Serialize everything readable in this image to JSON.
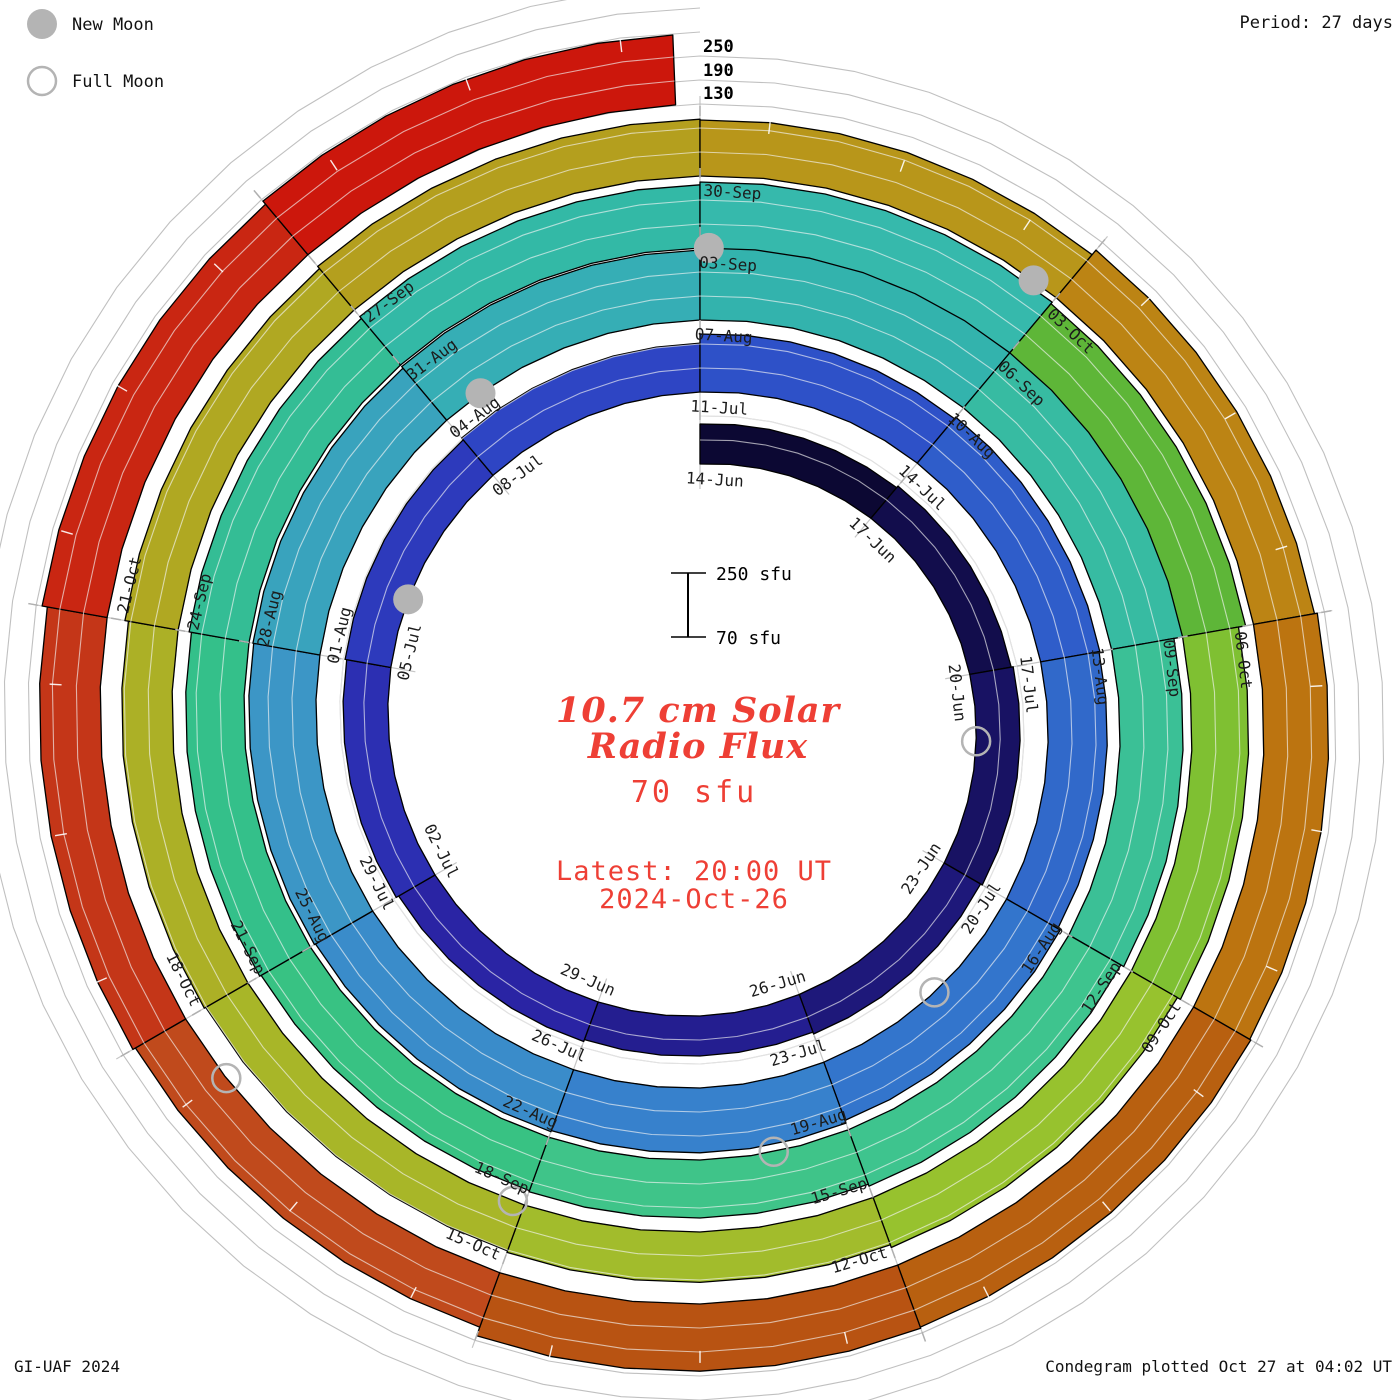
{
  "legend": {
    "new_moon_label": "New Moon",
    "full_moon_label": "Full Moon"
  },
  "period_label": "Period: 27 days",
  "credit": "GI-UAF 2024",
  "footer_note": "Condegram plotted Oct 27 at 04:02 UT",
  "radial_scale_labels": [
    "250",
    "190",
    "130"
  ],
  "center": {
    "scalebar_top": "250 sfu",
    "scalebar_bottom": "70 sfu",
    "title_line1": "10.7 cm Solar",
    "title_line2": "Radio Flux",
    "baseline_label": "70 sfu",
    "latest_line1": "Latest: 20:00 UT",
    "latest_line2": "2024-Oct-26"
  },
  "colors": {
    "text_red": "#ee3f35",
    "moon_gray": "#b4b4b4",
    "grid_gray": "#c0c0c0",
    "radial_gray": "#c6c6c6",
    "tick_gray": "#b0b0b0",
    "label_black": "#1c1c1c"
  },
  "chart_data": {
    "type": "spiral-polar-condegram",
    "title": "10.7 cm Solar Radio Flux",
    "units": "sfu",
    "start_date": "2024-Jun-14",
    "end_date_value": "2024-Oct-26 20:00 UT",
    "period_days": 27,
    "segment_days": 3,
    "baseline_sfu": 70,
    "grid_levels_sfu": [
      130,
      190,
      250
    ],
    "total_days": 134.83,
    "boundary_date_labels": [
      "14-Jun",
      "17-Jun",
      "20-Jun",
      "23-Jun",
      "26-Jun",
      "29-Jun",
      "02-Jul",
      "05-Jul",
      "08-Jul",
      "11-Jul",
      "14-Jul",
      "17-Jul",
      "20-Jul",
      "23-Jul",
      "26-Jul",
      "29-Jul",
      "01-Aug",
      "04-Aug",
      "07-Aug",
      "10-Aug",
      "13-Aug",
      "16-Aug",
      "19-Aug",
      "22-Aug",
      "25-Aug",
      "28-Aug",
      "31-Aug",
      "03-Sep",
      "06-Sep",
      "09-Sep",
      "12-Sep",
      "15-Sep",
      "18-Sep",
      "21-Sep",
      "24-Sep",
      "27-Sep",
      "30-Sep",
      "03-Oct",
      "06-Oct",
      "09-Oct",
      "12-Oct",
      "15-Oct",
      "18-Oct",
      "21-Oct"
    ],
    "segment_flux_sfu": [
      170,
      175,
      180,
      175,
      170,
      175,
      182,
      186,
      192,
      215,
      220,
      218,
      225,
      232,
      235,
      238,
      240,
      245,
      268,
      252,
      228,
      220,
      215,
      212,
      216,
      222,
      228,
      235,
      230,
      212,
      203,
      196,
      192,
      196,
      205,
      212,
      210,
      225,
      232,
      235,
      238,
      215,
      222,
      235,
      245
    ],
    "segment_colors": [
      "#0c0833",
      "#120d4c",
      "#181263",
      "#1e187a",
      "#241e90",
      "#2a24a4",
      "#2c2fb2",
      "#2d3abc",
      "#2e45c4",
      "#2e51c8",
      "#2f5dca",
      "#3169ca",
      "#3375cc",
      "#3781cc",
      "#3a8cca",
      "#3c96c6",
      "#39a3bd",
      "#36aeb5",
      "#33b3ad",
      "#37bba2",
      "#3bc096",
      "#3ec48e",
      "#3fc489",
      "#38c283",
      "#34c08a",
      "#34bd95",
      "#33b9a6",
      "#36b9ac",
      "#5eb638",
      "#7fc032",
      "#97c22e",
      "#a2bc2c",
      "#a8b628",
      "#acb026",
      "#b0a822",
      "#b49f1e",
      "#b8961a",
      "#bc8414",
      "#bc7410",
      "#b86010",
      "#b85312",
      "#c04a1c",
      "#c43618",
      "#c92612",
      "#cc170c"
    ],
    "new_moon_day_offsets": [
      21.96,
      51.47,
      81.08,
      110.78
    ],
    "full_moon_day_offsets": [
      7.05,
      37.43,
      66.77,
      96.1,
      125.48
    ]
  }
}
